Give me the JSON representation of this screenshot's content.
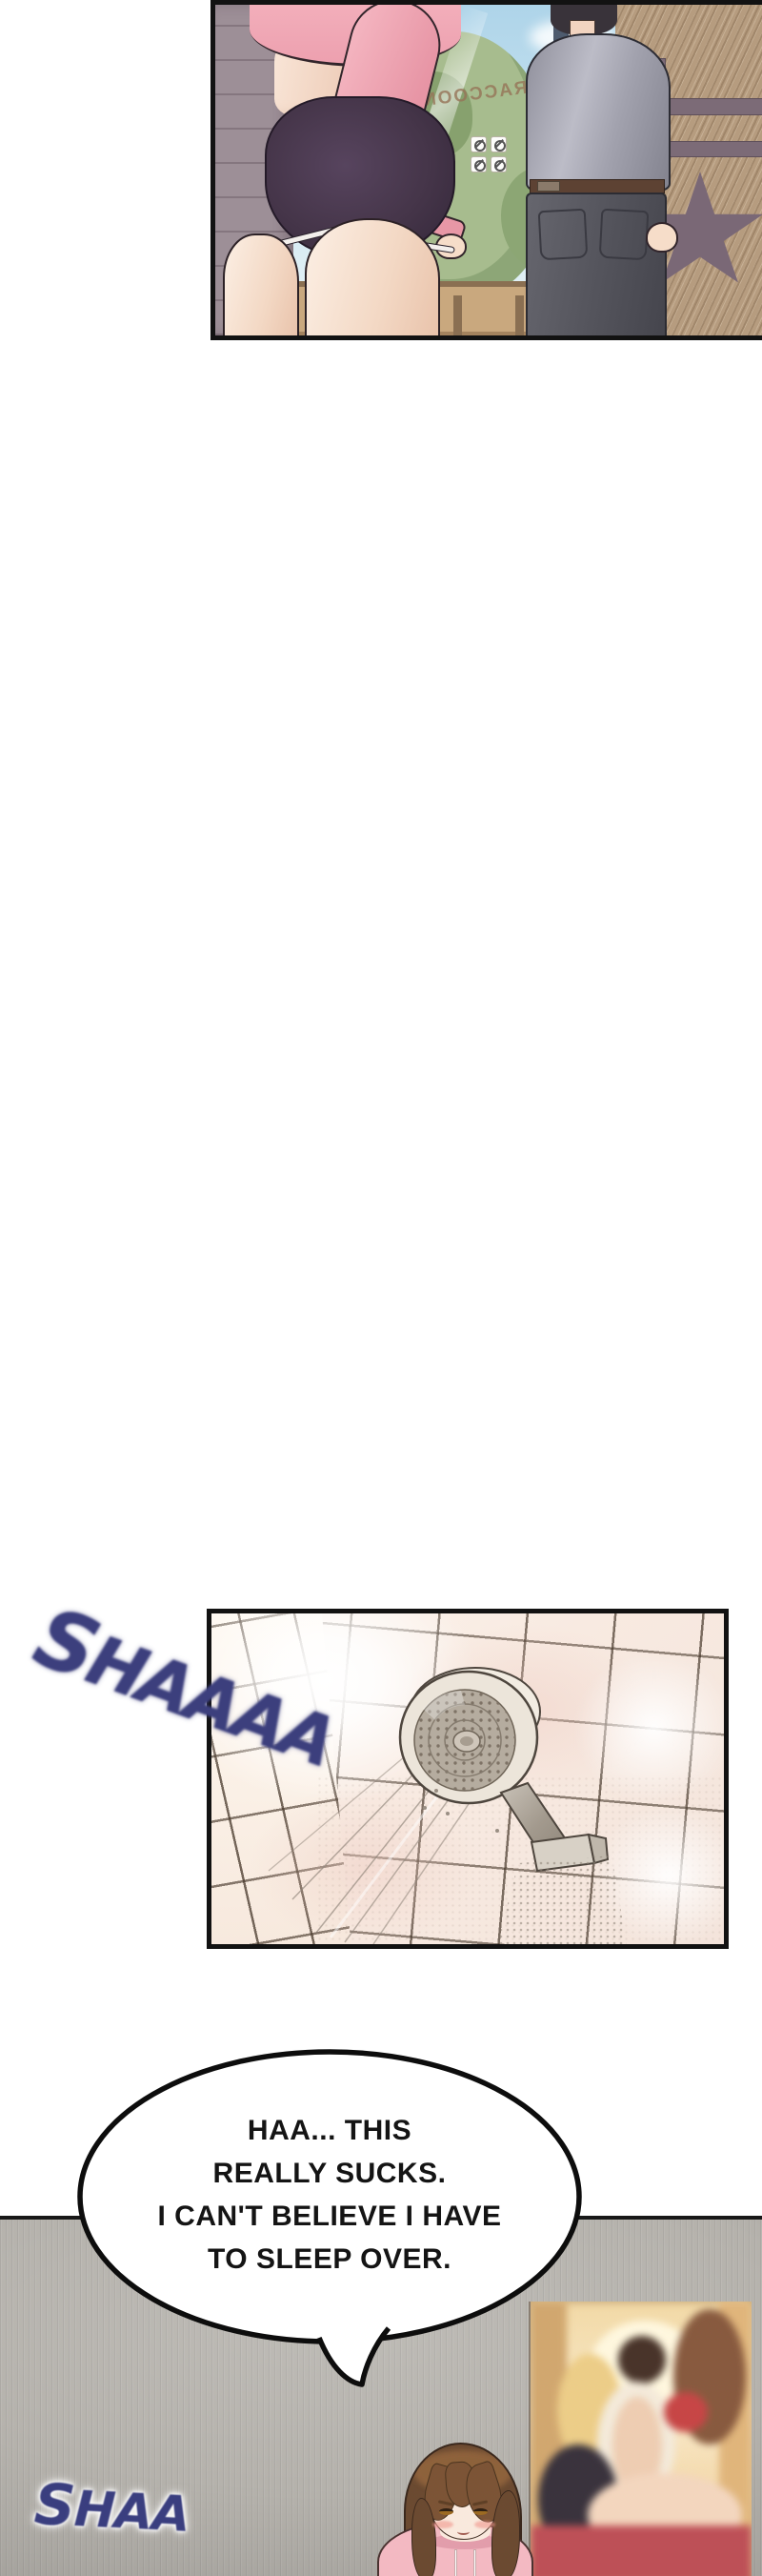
{
  "page_type": "webtoon comic page",
  "sfx": {
    "shower": "SHAAAA",
    "ambient": "SHAA"
  },
  "speech_bubble": {
    "lines": [
      "HAA... THIS",
      "REALLY SUCKS.",
      "I CAN'T BELIEVE I HAVE",
      "TO SLEEP OVER."
    ]
  },
  "street_panel": {
    "description": "Woman in pink cropped hoodie and dark shorts and man in gray shirt seen from behind outside a glass door",
    "glass_text_mirrored": "RACCOONS",
    "signs": [
      "no-smoking",
      "no-food",
      "no-power",
      "no-scooter"
    ]
  },
  "shower_panel": {
    "description": "Chrome handheld shower head spraying water against a tiled bathroom wall"
  },
  "room_panel": {
    "description": "Worried girl with long brown hair in pink hoodie standing by a wall with a pin-up poster",
    "poster_description": "Warm-toned pin-up style poster with several figures"
  },
  "colors": {
    "sfx_navy": "#3c3f7d",
    "hoodie_pink": "#f3b0bc",
    "shorts_plum": "#453549",
    "shirt_gray": "#a2a2ae",
    "wall_tan": "#b69c7f",
    "room_wall_gray": "#b5b2ac",
    "poster_red": "#c24f56",
    "panel_border": "#121212"
  }
}
